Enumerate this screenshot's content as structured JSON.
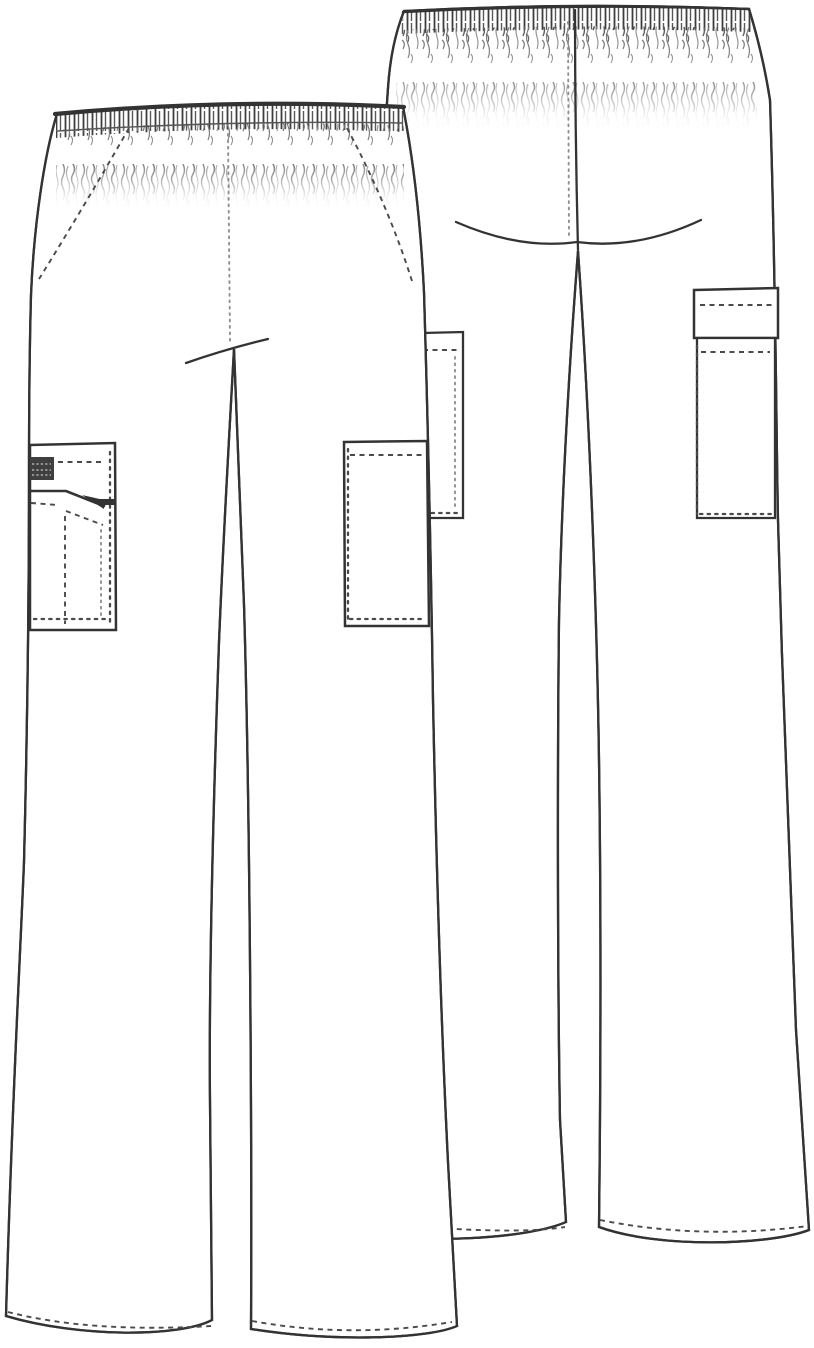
{
  "page": {
    "background": "#ffffff"
  },
  "illustration": {
    "type": "technical-flat-sketch",
    "subject": "scrub pants line drawing, front and back views",
    "views": [
      {
        "id": "front",
        "label": "front view"
      },
      {
        "id": "back",
        "label": "back view"
      }
    ],
    "parts": {
      "front": [
        "elastic shirred waistband",
        "side slash pockets",
        "left leg cargo pocket with brand label patch and pen slot",
        "right leg patch pocket",
        "center front fly stitch",
        "stitched flare hems"
      ],
      "back": [
        "elastic shirred waistband",
        "center back seam",
        "seat curve",
        "right leg cargo pocket with flap",
        "left leg patch pocket partially hidden",
        "stitched flare hems"
      ]
    },
    "colors": {
      "background": "#ffffff",
      "line": "#333333",
      "line_soft": "#555555",
      "stitch": "#4a4a4a",
      "stitch_light": "#8f8f8f",
      "label_patch": "#3f3f3f",
      "label_stripe": "#c4c4c4"
    }
  }
}
